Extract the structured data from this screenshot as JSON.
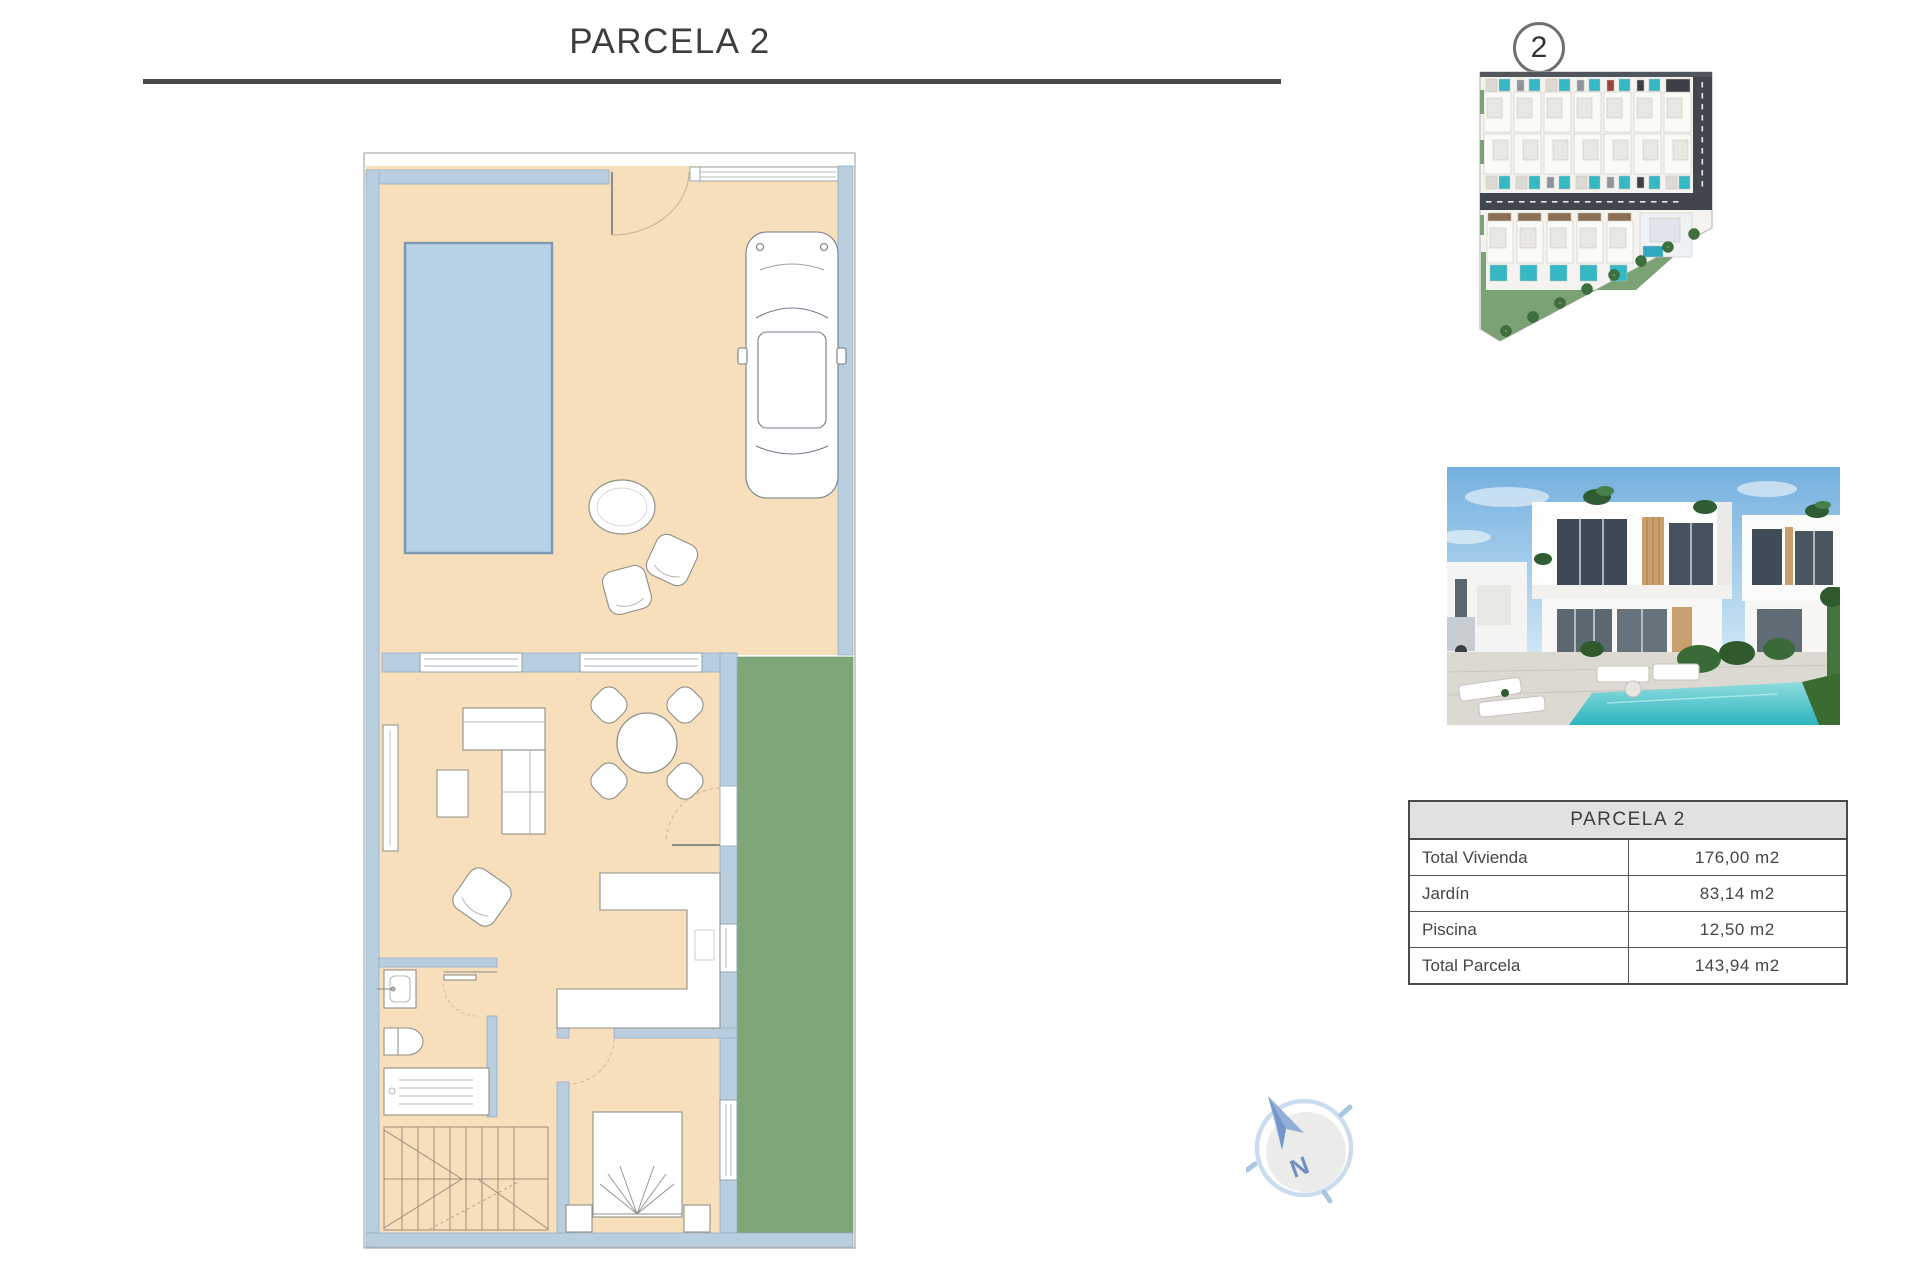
{
  "header": {
    "title": "PARCELA 2"
  },
  "site_plan": {
    "badge_number": "2"
  },
  "summary_table": {
    "header": "PARCELA 2",
    "rows": [
      {
        "label": "Total Vivienda",
        "value": "176,00 m2"
      },
      {
        "label": "Jardín",
        "value": "83,14 m2"
      },
      {
        "label": "Piscina",
        "value": "12,50 m2"
      },
      {
        "label": "Total Parcela",
        "value": "143,94 m2"
      }
    ]
  },
  "compass": {
    "label": "N"
  },
  "colors": {
    "title_text": "#3e3d3d",
    "rule": "#4b4747",
    "floor_cream": "#f8dfbc",
    "wall_blue": "#b9cfe0",
    "pool_blue": "#b7d2e6",
    "garden_green": "#7ea678",
    "road_dark": "#41464c",
    "plan_pool_teal": "#34b8c3",
    "photo_pool_teal": "#3cc0c6",
    "table_header_bg": "#e2e1e0"
  }
}
